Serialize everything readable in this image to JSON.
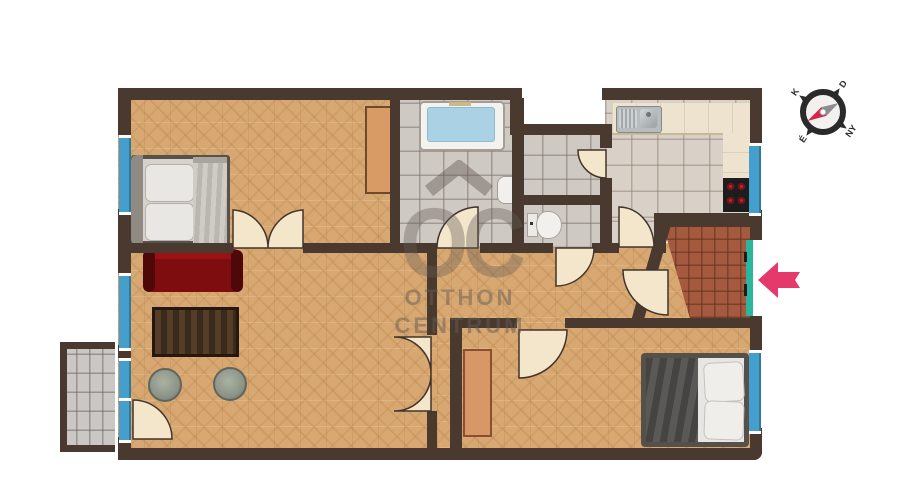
{
  "watermark": {
    "logo": "OC",
    "line1": "OTTHON",
    "line2": "CENTRUM"
  },
  "compass": {
    "north": "É",
    "east": "K",
    "south": "D",
    "west": "NY"
  },
  "colors": {
    "wall": "#4A392F",
    "parquet": "#D8A872",
    "bathTile": "#CFC9C4",
    "kitchenTile": "#D9D1C7",
    "entranceTile": "#A5593F",
    "balconyTile": "#CBC7C4",
    "window": "#459FCD",
    "door": "#F3E6CB",
    "sofa": "#7E0D10",
    "table": "#3A2A1B",
    "pouf": "#96A092",
    "tubWater": "#ABD2E4",
    "counter": "#EEE3CF",
    "stove": "#1D1D1D",
    "burner": "#C2242E",
    "teal": "#2BB79B",
    "arrow": "#E5396B",
    "rug": "#D79767",
    "wardrobe": "#D89B66",
    "watermark": "rgba(100,92,84,0.45)"
  }
}
